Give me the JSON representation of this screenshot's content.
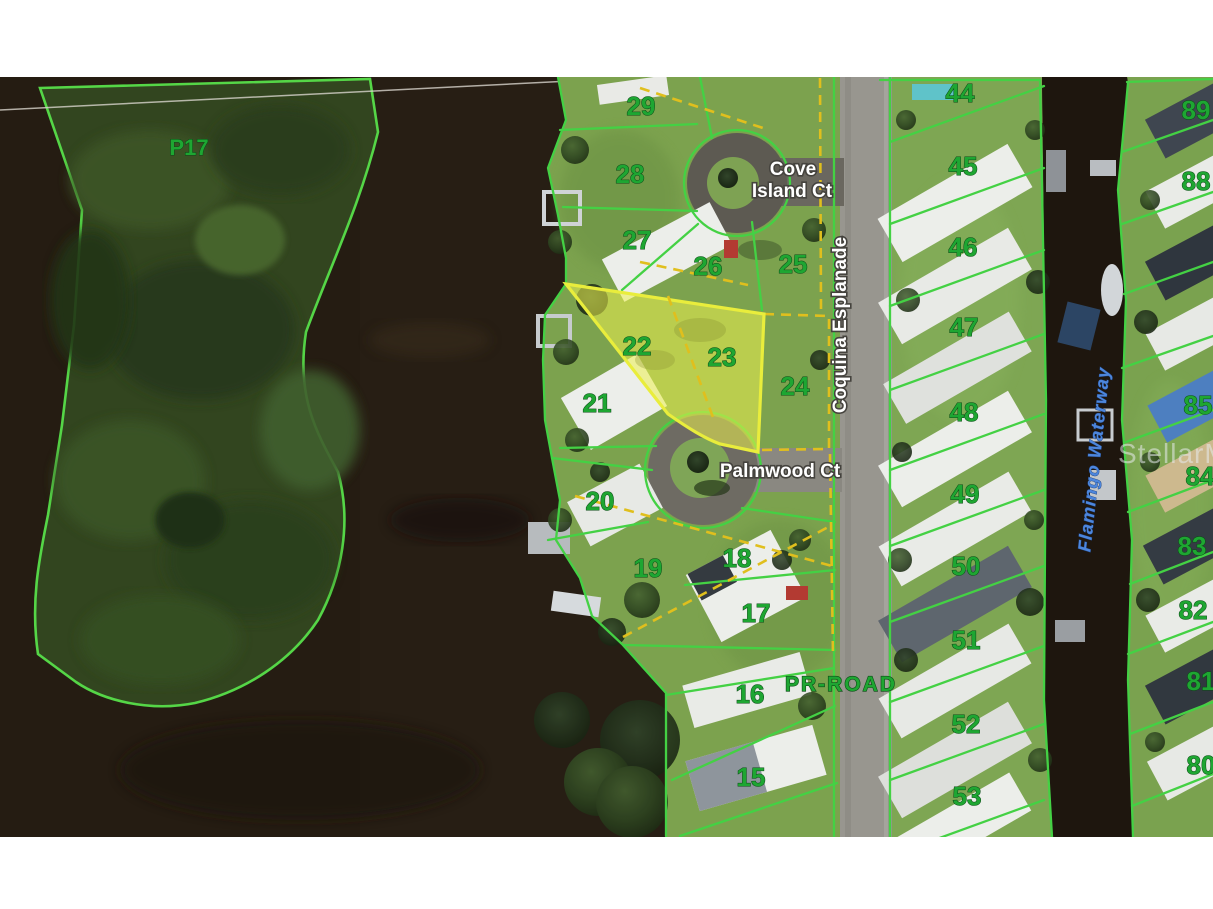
{
  "watermark": "StellarMLS",
  "map": {
    "preserve": "P17",
    "streets": {
      "cove_line1": "Cove",
      "cove_line2": "Island Ct",
      "coquina": "Coquina Esplanade",
      "palmwood": "Palmwood Ct",
      "pr_road": "PR-ROAD",
      "waterway": "Flamingo Waterway"
    },
    "lots_west": [
      "29",
      "28",
      "27",
      "26",
      "25",
      "22",
      "23",
      "21",
      "24",
      "20",
      "19",
      "18",
      "17",
      "16",
      "15"
    ],
    "lots_east": [
      "44",
      "45",
      "46",
      "47",
      "48",
      "49",
      "50",
      "51",
      "52",
      "53"
    ],
    "lots_far_east": [
      "89",
      "88",
      "85",
      "84",
      "83",
      "82",
      "81",
      "80"
    ],
    "highlighted_lots": [
      "22",
      "23"
    ],
    "colors": {
      "parcel_line": "#44d144",
      "lot_text": "#1ea632",
      "highlight_fill": "#ecf04f",
      "highlight_border": "#e9ed3c",
      "easement_dash": "#e0bf1d",
      "street_text": "#ffffff",
      "waterway_text": "#4d86dc",
      "water": "#241b11"
    }
  }
}
